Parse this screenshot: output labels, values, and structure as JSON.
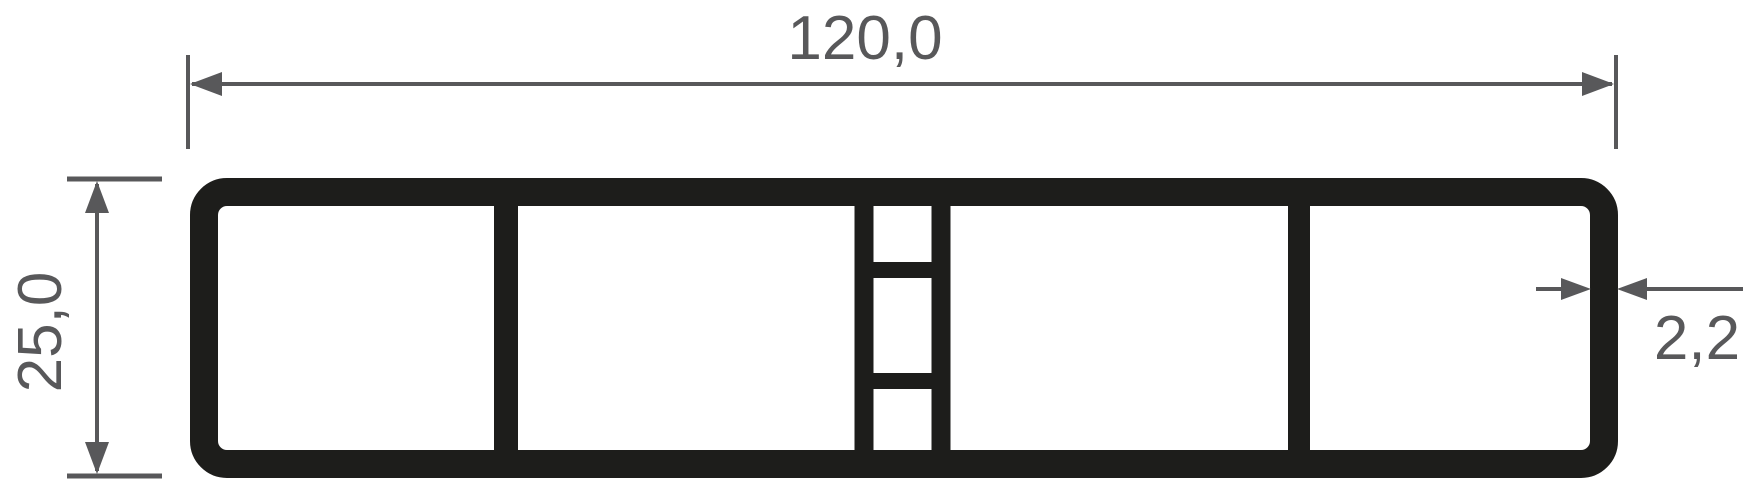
{
  "diagram": {
    "type": "technical-drawing-cross-section",
    "subject": "rectangular multi-chamber hollow profile",
    "background": "#ffffff",
    "colors": {
      "profile_line": "#1d1d1b",
      "dimension_line": "#58585a",
      "dimension_text": "#58585a"
    },
    "dimensions": {
      "width_label": "120,0",
      "height_label": "25,0",
      "wall_thickness_label": "2,2"
    },
    "structure": {
      "outer_shape": "rounded rectangle",
      "large_chambers": 4,
      "small_center_chambers": 3
    }
  }
}
